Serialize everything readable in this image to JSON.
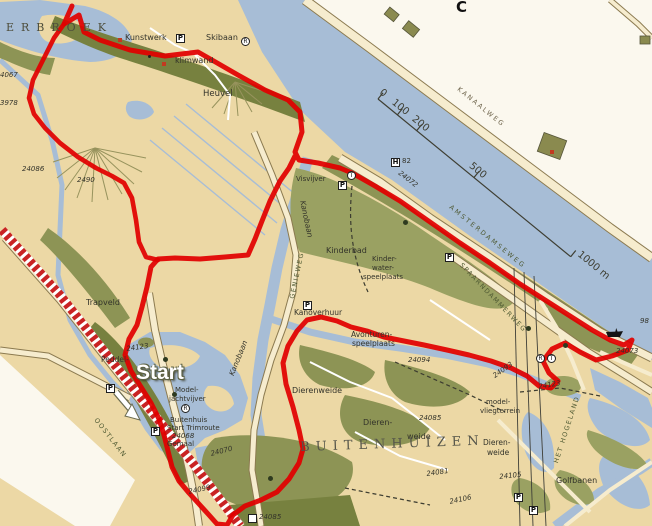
{
  "map": {
    "colors": {
      "water": "#a7bdd6",
      "land": "#ecd8a5",
      "green": "#9aa162",
      "green_mid": "#8d9455",
      "green_dark": "#77813f",
      "road": "#f6ecce",
      "casing": "#8b7a50",
      "white_land": "#fbf8ee",
      "route": "#e10000",
      "hatch": "#c92323",
      "label": "#33332a",
      "road_label": "#4f5a33"
    },
    "labels": [
      {
        "t": "ERBROEK",
        "x": 6,
        "y": 22,
        "s": 11,
        "ls": 7,
        "f": 1,
        "c": "#4e4e3c",
        "n": "area-label-erbroek"
      },
      {
        "t": "Kunstwerk",
        "x": 125,
        "y": 34,
        "s": 8,
        "n": "poi-label-kunstwerk"
      },
      {
        "t": "klimwand",
        "x": 175,
        "y": 57,
        "s": 8,
        "n": "poi-label-klimwand"
      },
      {
        "t": "Skibaan",
        "x": 206,
        "y": 34,
        "s": 8,
        "n": "poi-label-skibaan"
      },
      {
        "t": "Heuvel",
        "x": 203,
        "y": 90,
        "s": 8.5,
        "n": "poi-label-heuvel"
      },
      {
        "t": "4067",
        "x": 0,
        "y": 72,
        "s": 7,
        "i": 1,
        "n": "route-number"
      },
      {
        "t": "3978",
        "x": 0,
        "y": 100,
        "s": 7,
        "i": 1,
        "n": "route-number"
      },
      {
        "t": "24086",
        "x": 22,
        "y": 166,
        "s": 7,
        "i": 1,
        "n": "route-number"
      },
      {
        "t": "2490",
        "x": 77,
        "y": 177,
        "s": 7,
        "i": 1,
        "n": "route-number"
      },
      {
        "t": "C",
        "x": 456,
        "y": 0,
        "s": 15,
        "w": 700,
        "c": "#111111",
        "n": "grid-letter"
      },
      {
        "t": "KANAALWEG",
        "x": 460,
        "y": 86,
        "s": 6.5,
        "r": 39,
        "ls": 2,
        "c": "#6b6148",
        "n": "road-label-kanaalweg"
      },
      {
        "t": "82",
        "x": 402,
        "y": 158,
        "s": 7,
        "n": "marker-number"
      },
      {
        "t": "24072",
        "x": 401,
        "y": 170,
        "s": 7,
        "r": 38,
        "i": 1,
        "n": "route-number"
      },
      {
        "t": "AMSTERDAMSEWEG",
        "x": 452,
        "y": 204,
        "s": 6.5,
        "r": 39,
        "ls": 2.2,
        "c": "#4f5a33",
        "n": "road-label-amsterdamseweg"
      },
      {
        "t": "SPAARNDAMMERWEG",
        "x": 463,
        "y": 262,
        "s": 6.5,
        "r": 46,
        "ls": 1.5,
        "c": "#4f5a33",
        "n": "road-label-spaarndammerweg"
      },
      {
        "t": "Kanobaan",
        "x": 306,
        "y": 200,
        "s": 7.5,
        "r": 78,
        "i": 1,
        "n": "water-label-kanobaan"
      },
      {
        "t": "Kanobaan",
        "x": 228,
        "y": 374,
        "s": 7.5,
        "r": -68,
        "i": 1,
        "n": "water-label-kanobaan"
      },
      {
        "t": "GENIEWEG",
        "x": 289,
        "y": 298,
        "s": 6.5,
        "r": -78,
        "ls": 1.5,
        "c": "#4f5a33",
        "n": "road-label-genieweg"
      },
      {
        "t": "Visvijver",
        "x": 296,
        "y": 176,
        "s": 7,
        "n": "poi-label-visvijver"
      },
      {
        "t": "Kinderbad",
        "x": 326,
        "y": 247,
        "s": 8,
        "n": "poi-label-kinderbad"
      },
      {
        "t": "Kinder-",
        "x": 372,
        "y": 256,
        "s": 7,
        "n": "poi-label"
      },
      {
        "t": "water-",
        "x": 372,
        "y": 265,
        "s": 7,
        "n": "poi-label"
      },
      {
        "t": "speelplaats",
        "x": 363,
        "y": 274,
        "s": 7,
        "n": "poi-label"
      },
      {
        "t": "Kanoverhuur",
        "x": 294,
        "y": 309,
        "s": 7.5,
        "n": "poi-label-kanoverhuur"
      },
      {
        "t": "Avonturen-",
        "x": 351,
        "y": 331,
        "s": 7.5,
        "n": "poi-label"
      },
      {
        "t": "speelplaats",
        "x": 352,
        "y": 340,
        "s": 7.5,
        "n": "poi-label"
      },
      {
        "t": "Dierenweide",
        "x": 292,
        "y": 387,
        "s": 8,
        "n": "poi-label-dierenweide"
      },
      {
        "t": "Dieren-",
        "x": 363,
        "y": 419,
        "s": 8,
        "n": "poi-label"
      },
      {
        "t": "weide",
        "x": 407,
        "y": 433,
        "s": 8,
        "n": "poi-label"
      },
      {
        "t": "BUITENHUIZEN",
        "x": 300,
        "y": 441,
        "s": 13,
        "ls": 6,
        "f": 1,
        "c": "#55554a",
        "r": -2,
        "n": "area-label-buitenhuizen"
      },
      {
        "t": "model-",
        "x": 486,
        "y": 399,
        "s": 7,
        "n": "poi-label"
      },
      {
        "t": "vliegterrein",
        "x": 480,
        "y": 408,
        "s": 7,
        "n": "poi-label"
      },
      {
        "t": "Dieren-",
        "x": 483,
        "y": 439,
        "s": 7.5,
        "n": "poi-label"
      },
      {
        "t": "weide",
        "x": 487,
        "y": 449,
        "s": 7.5,
        "n": "poi-label"
      },
      {
        "t": "24094",
        "x": 408,
        "y": 357,
        "s": 7,
        "i": 1,
        "n": "route-number"
      },
      {
        "t": "24085",
        "x": 419,
        "y": 415,
        "s": 7,
        "i": 1,
        "n": "route-number"
      },
      {
        "t": "24081",
        "x": 426,
        "y": 471,
        "s": 7,
        "i": 1,
        "r": -8,
        "n": "route-number"
      },
      {
        "t": "24106",
        "x": 449,
        "y": 499,
        "s": 7,
        "i": 1,
        "r": -12,
        "n": "route-number"
      },
      {
        "t": "24093",
        "x": 492,
        "y": 374,
        "s": 7,
        "i": 1,
        "r": -35,
        "n": "route-number"
      },
      {
        "t": "24105",
        "x": 499,
        "y": 474,
        "s": 7,
        "i": 1,
        "r": -6,
        "n": "route-number"
      },
      {
        "t": "Golfbanen",
        "x": 556,
        "y": 477,
        "s": 8,
        "n": "poi-label-golfbanen"
      },
      {
        "t": "HET HOGELAND",
        "x": 553,
        "y": 462,
        "s": 6.5,
        "r": -72,
        "ls": 1.5,
        "c": "#4f5a33",
        "n": "road-label-het-hogeland"
      },
      {
        "t": "24123",
        "x": 538,
        "y": 384,
        "s": 7,
        "i": 1,
        "r": -10,
        "n": "route-number"
      },
      {
        "t": "24123",
        "x": 126,
        "y": 346,
        "s": 7,
        "i": 1,
        "r": -8,
        "n": "route-number"
      },
      {
        "t": "Peddel-",
        "x": 101,
        "y": 356,
        "s": 7.5,
        "n": "poi-label"
      },
      {
        "t": "Start",
        "x": 136,
        "y": 362,
        "s": 21,
        "cls": "start-label",
        "n": "start-label"
      },
      {
        "t": "Model-",
        "x": 175,
        "y": 387,
        "s": 7,
        "n": "poi-label"
      },
      {
        "t": "jachtvijver",
        "x": 169,
        "y": 396,
        "s": 7,
        "n": "poi-label"
      },
      {
        "t": "Buitenhuis",
        "x": 170,
        "y": 417,
        "s": 7,
        "n": "poi-label"
      },
      {
        "t": "Start Trimroute",
        "x": 167,
        "y": 425,
        "s": 7,
        "n": "poi-label-start-trimroute"
      },
      {
        "t": "24068",
        "x": 172,
        "y": 433,
        "s": 7,
        "i": 1,
        "n": "route-number"
      },
      {
        "t": "Gemaal",
        "x": 167,
        "y": 441,
        "s": 7,
        "n": "poi-label-gemaal"
      },
      {
        "t": "24070",
        "x": 210,
        "y": 451,
        "s": 7,
        "i": 1,
        "r": -14,
        "n": "route-number"
      },
      {
        "t": "24099",
        "x": 188,
        "y": 489,
        "s": 7,
        "i": 1,
        "r": -12,
        "n": "route-number"
      },
      {
        "t": "24085",
        "x": 259,
        "y": 514,
        "s": 7,
        "i": 1,
        "n": "route-number"
      },
      {
        "t": "Trapveld",
        "x": 86,
        "y": 299,
        "s": 8,
        "n": "poi-label-trapveld"
      },
      {
        "t": "OOSTLAAN",
        "x": 98,
        "y": 417,
        "s": 6.5,
        "r": 52,
        "ls": 1.5,
        "c": "#4f5a33",
        "n": "road-label-oostlaan"
      },
      {
        "t": "98",
        "x": 640,
        "y": 318,
        "s": 7,
        "i": 1,
        "n": "route-number"
      },
      {
        "t": "24073",
        "x": 616,
        "y": 348,
        "s": 7,
        "i": 1,
        "n": "route-number"
      }
    ],
    "icons": [
      {
        "n": "parking-icon",
        "g": "P",
        "k": "sq",
        "x": 176,
        "y": 34
      },
      {
        "n": "parking-icon",
        "g": "P",
        "k": "sq",
        "x": 338,
        "y": 181
      },
      {
        "n": "parking-icon",
        "g": "P",
        "k": "sq",
        "x": 445,
        "y": 253
      },
      {
        "n": "parking-icon",
        "g": "P",
        "k": "sq",
        "x": 106,
        "y": 384
      },
      {
        "n": "parking-icon",
        "g": "P",
        "k": "sq",
        "x": 514,
        "y": 493
      },
      {
        "n": "parking-icon",
        "g": "P",
        "k": "sq",
        "x": 529,
        "y": 506
      },
      {
        "n": "parking-icon",
        "g": "P",
        "k": "sq",
        "x": 303,
        "y": 301
      },
      {
        "n": "parking-icon",
        "g": "P",
        "k": "sq",
        "x": 151,
        "y": 427
      },
      {
        "n": "hotel-marker-icon",
        "g": "H",
        "k": "sq",
        "x": 391,
        "y": 158
      },
      {
        "n": "poi-marker-icon",
        "g": "",
        "k": "sq",
        "x": 248,
        "y": 514
      },
      {
        "n": "restaurant-icon",
        "g": "R",
        "k": "c",
        "x": 241,
        "y": 37
      },
      {
        "n": "restaurant-icon",
        "g": "R",
        "k": "c",
        "x": 181,
        "y": 404
      },
      {
        "n": "restaurant-icon",
        "g": "R",
        "k": "c",
        "x": 536,
        "y": 354
      },
      {
        "n": "teahouse-icon",
        "g": "T",
        "k": "c",
        "x": 347,
        "y": 171
      },
      {
        "n": "teahouse-icon",
        "g": "T",
        "k": "c",
        "x": 547,
        "y": 354
      },
      {
        "n": "ferry-icon",
        "k": "boat",
        "x": 606,
        "y": 328
      },
      {
        "n": "tree-icon",
        "k": "tree",
        "x": 403,
        "y": 220
      },
      {
        "n": "tree-icon",
        "k": "tree",
        "x": 526,
        "y": 326
      },
      {
        "n": "tree-icon",
        "k": "tree",
        "x": 268,
        "y": 476
      },
      {
        "n": "tree-icon",
        "k": "tree",
        "x": 563,
        "y": 343
      },
      {
        "n": "tree-icon",
        "k": "tree",
        "x": 163,
        "y": 357
      },
      {
        "n": "tree-icon",
        "k": "tree",
        "x": 172,
        "y": 392
      },
      {
        "n": "kunstwerk-dot-icon",
        "k": "dot",
        "x": 148,
        "y": 55
      },
      {
        "n": "building-icon",
        "k": "red",
        "x": 550,
        "y": 150
      },
      {
        "n": "building-icon",
        "k": "red",
        "x": 118,
        "y": 38
      },
      {
        "n": "building-icon",
        "k": "red",
        "x": 162,
        "y": 62
      }
    ],
    "routes": {
      "main": [
        [
          72,
          6
        ],
        [
          64,
          24
        ],
        [
          79,
          15
        ],
        [
          84,
          32
        ],
        [
          100,
          40
        ],
        [
          130,
          50
        ],
        [
          165,
          56
        ],
        [
          198,
          52
        ],
        [
          212,
          60
        ],
        [
          238,
          75
        ],
        [
          265,
          90
        ],
        [
          288,
          100
        ],
        [
          300,
          112
        ],
        [
          302,
          132
        ],
        [
          295,
          152
        ],
        [
          299,
          160
        ],
        [
          318,
          163
        ],
        [
          340,
          168
        ],
        [
          352,
          173
        ],
        [
          375,
          186
        ],
        [
          400,
          201
        ],
        [
          430,
          222
        ],
        [
          460,
          243
        ],
        [
          490,
          263
        ],
        [
          520,
          284
        ],
        [
          545,
          300
        ],
        [
          570,
          316
        ],
        [
          592,
          330
        ],
        [
          610,
          340
        ],
        [
          624,
          345
        ],
        [
          632,
          340
        ],
        [
          628,
          350
        ],
        [
          612,
          356
        ],
        [
          596,
          360
        ],
        [
          580,
          352
        ],
        [
          565,
          343
        ],
        [
          552,
          349
        ],
        [
          543,
          361
        ],
        [
          549,
          373
        ],
        [
          558,
          381
        ],
        [
          551,
          388
        ],
        [
          539,
          386
        ],
        [
          527,
          376
        ],
        [
          511,
          368
        ],
        [
          491,
          361
        ],
        [
          469,
          355
        ],
        [
          447,
          350
        ],
        [
          424,
          345
        ],
        [
          404,
          341
        ],
        [
          384,
          337
        ],
        [
          367,
          331
        ],
        [
          351,
          327
        ],
        [
          337,
          321
        ],
        [
          321,
          317
        ],
        [
          307,
          320
        ],
        [
          297,
          331
        ],
        [
          288,
          346
        ],
        [
          283,
          363
        ],
        [
          286,
          384
        ],
        [
          293,
          407
        ],
        [
          299,
          430
        ],
        [
          303,
          449
        ],
        [
          299,
          463
        ],
        [
          289,
          479
        ],
        [
          277,
          492
        ],
        [
          261,
          500
        ],
        [
          245,
          506
        ],
        [
          233,
          515
        ],
        [
          227,
          525
        ],
        [
          217,
          524
        ],
        [
          209,
          515
        ],
        [
          199,
          504
        ],
        [
          189,
          493
        ],
        [
          179,
          481
        ],
        [
          172,
          467
        ],
        [
          168,
          451
        ],
        [
          164,
          435
        ],
        [
          159,
          419
        ],
        [
          151,
          403
        ],
        [
          141,
          387
        ],
        [
          131,
          371
        ],
        [
          125,
          355
        ],
        [
          129,
          339
        ],
        [
          137,
          325
        ],
        [
          142,
          307
        ],
        [
          147,
          287
        ],
        [
          151,
          267
        ],
        [
          158,
          259
        ],
        [
          175,
          258
        ],
        [
          200,
          259
        ],
        [
          225,
          257
        ],
        [
          248,
          255
        ],
        [
          255,
          239
        ],
        [
          262,
          221
        ],
        [
          270,
          201
        ],
        [
          280,
          181
        ],
        [
          289,
          168
        ],
        [
          296,
          154
        ]
      ],
      "left_branch": [
        [
          64,
          24
        ],
        [
          54,
          38
        ],
        [
          43,
          60
        ],
        [
          33,
          80
        ],
        [
          29,
          98
        ],
        [
          34,
          114
        ],
        [
          45,
          128
        ],
        [
          60,
          143
        ],
        [
          78,
          157
        ],
        [
          96,
          168
        ],
        [
          112,
          176
        ],
        [
          124,
          183
        ],
        [
          132,
          198
        ],
        [
          136,
          220
        ],
        [
          139,
          242
        ],
        [
          146,
          257
        ],
        [
          158,
          260
        ]
      ]
    },
    "scalebar": {
      "origin": [
        378,
        99
      ],
      "angle": 39.3,
      "length": 249,
      "ticks": [
        0,
        25,
        50,
        124,
        249
      ],
      "labels": [
        {
          "t": "0",
          "x": -3
        },
        {
          "t": "100",
          "x": 13
        },
        {
          "t": "200",
          "x": 39
        },
        {
          "t": "500",
          "x": 113
        },
        {
          "t": "1000 m",
          "x": 253
        }
      ]
    }
  }
}
